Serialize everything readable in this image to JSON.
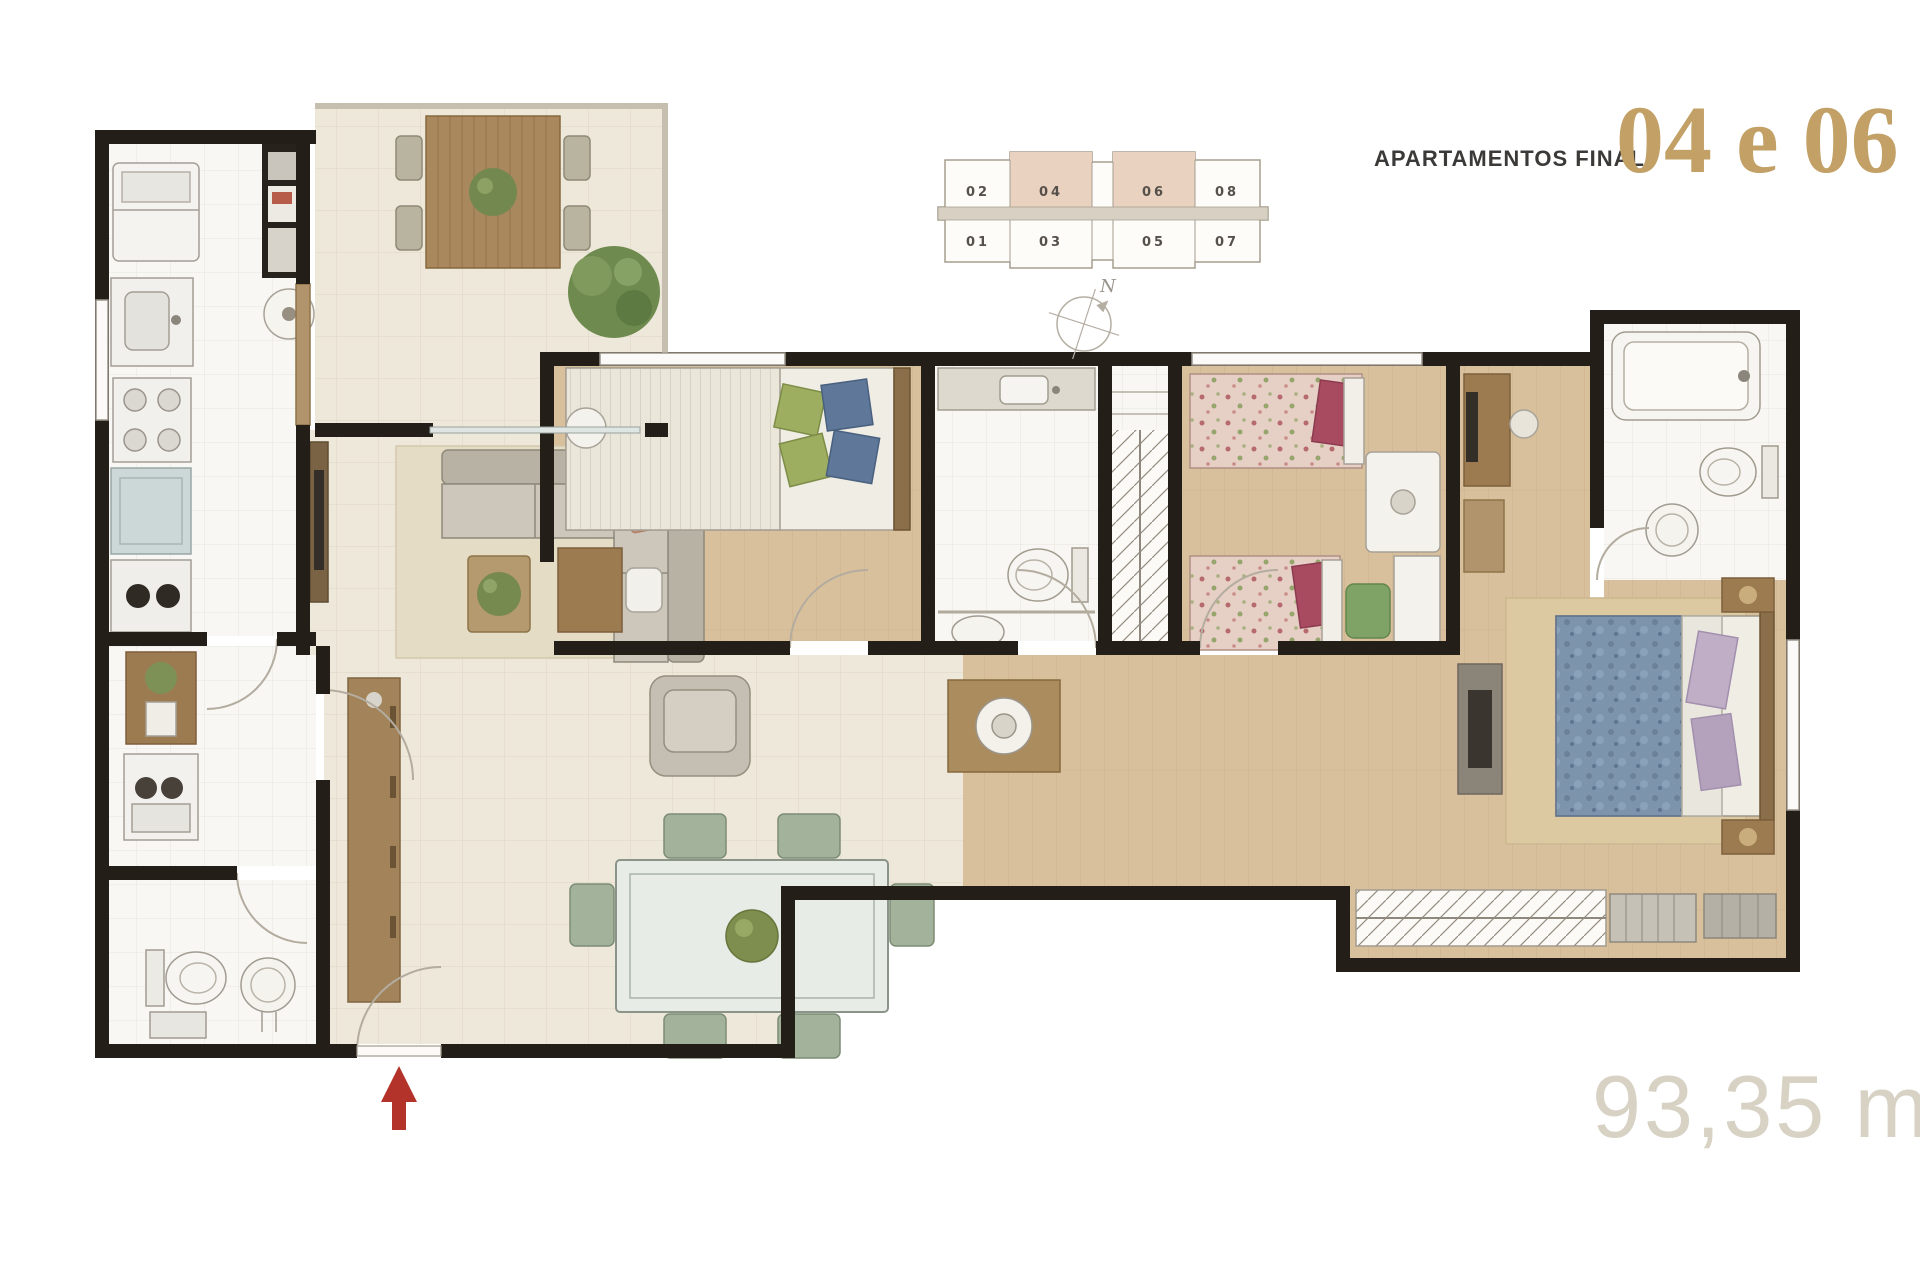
{
  "title": {
    "label": "APARTAMENTOS FINAL",
    "units": "04 e 06"
  },
  "area_label": "93,35 m²",
  "compass": {
    "north": "N"
  },
  "key_plan": {
    "top_row": [
      "02",
      "04",
      "06",
      "08"
    ],
    "bottom_row": [
      "01",
      "03",
      "05",
      "07"
    ],
    "highlighted": "04, 06"
  },
  "colors": {
    "accent_gold": "#c2a066",
    "title_text": "#3b3a38",
    "area_text": "#d8d2c5",
    "wall": "#231e18",
    "keyplan_highlight": "#e9d2bf",
    "entrance_arrow": "#b33229",
    "tile_beige": "#eee8da",
    "tile_white": "#f8f7f4",
    "wood": "#d9c09d"
  },
  "rooms": [
    "terrace",
    "kitchen",
    "laundry",
    "service-bathroom",
    "living-room",
    "dining-room",
    "bedroom-1",
    "social-bathroom",
    "closet",
    "bedroom-2",
    "hallway",
    "master-suite",
    "suite-bathroom"
  ]
}
